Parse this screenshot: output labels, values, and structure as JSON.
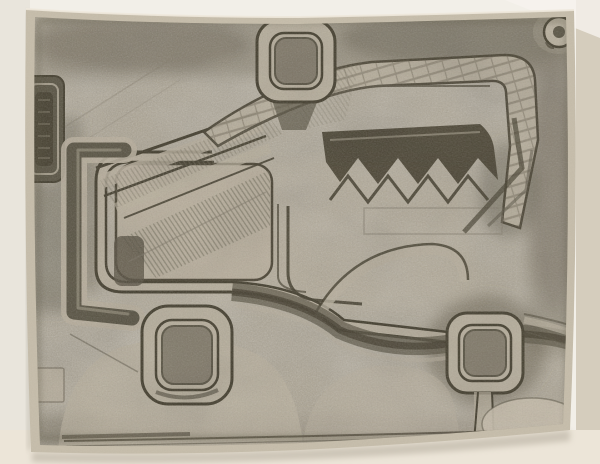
{
  "scene": {
    "type": "photograph",
    "subject": "abstract monochrome print propped upright against a white backdrop",
    "motif": "stylized vehicle-like creature with three rounded-square wheels, a small grommet ring, zigzag teeth, hatched diagonal bands, bracket and plaque shapes",
    "medium_look": "grainy graphite etching on grey-tan paper, photographed with slight tilt"
  },
  "palette": {
    "wall": "#f2efe8",
    "wall_left": "#e9e5dc",
    "wall_right": "#d5cdbd",
    "wall_bottom": "#ece5d8",
    "shadow": "#b3ab9c",
    "paper": "#aba28f",
    "margin": "#c6bdaa",
    "light": "#bcb3a0",
    "lighter": "#cac1ae",
    "mid": "#847c6b",
    "ink": "#5a5443",
    "ink_dark": "#443e2d",
    "paper_edge": "#eee8dc"
  },
  "artwork_parts": [
    "top-wheel",
    "front-wheel",
    "rear-wheel",
    "grommet-ring",
    "left-plaque",
    "left-bracket",
    "body-outline",
    "body-panel",
    "neck-bands",
    "head-arch",
    "mouth-zigzag",
    "chassis-band",
    "front-mound",
    "mid-mound",
    "rear-fender",
    "tail-lines",
    "rear-ellipse",
    "ground-lines",
    "corner-square"
  ]
}
